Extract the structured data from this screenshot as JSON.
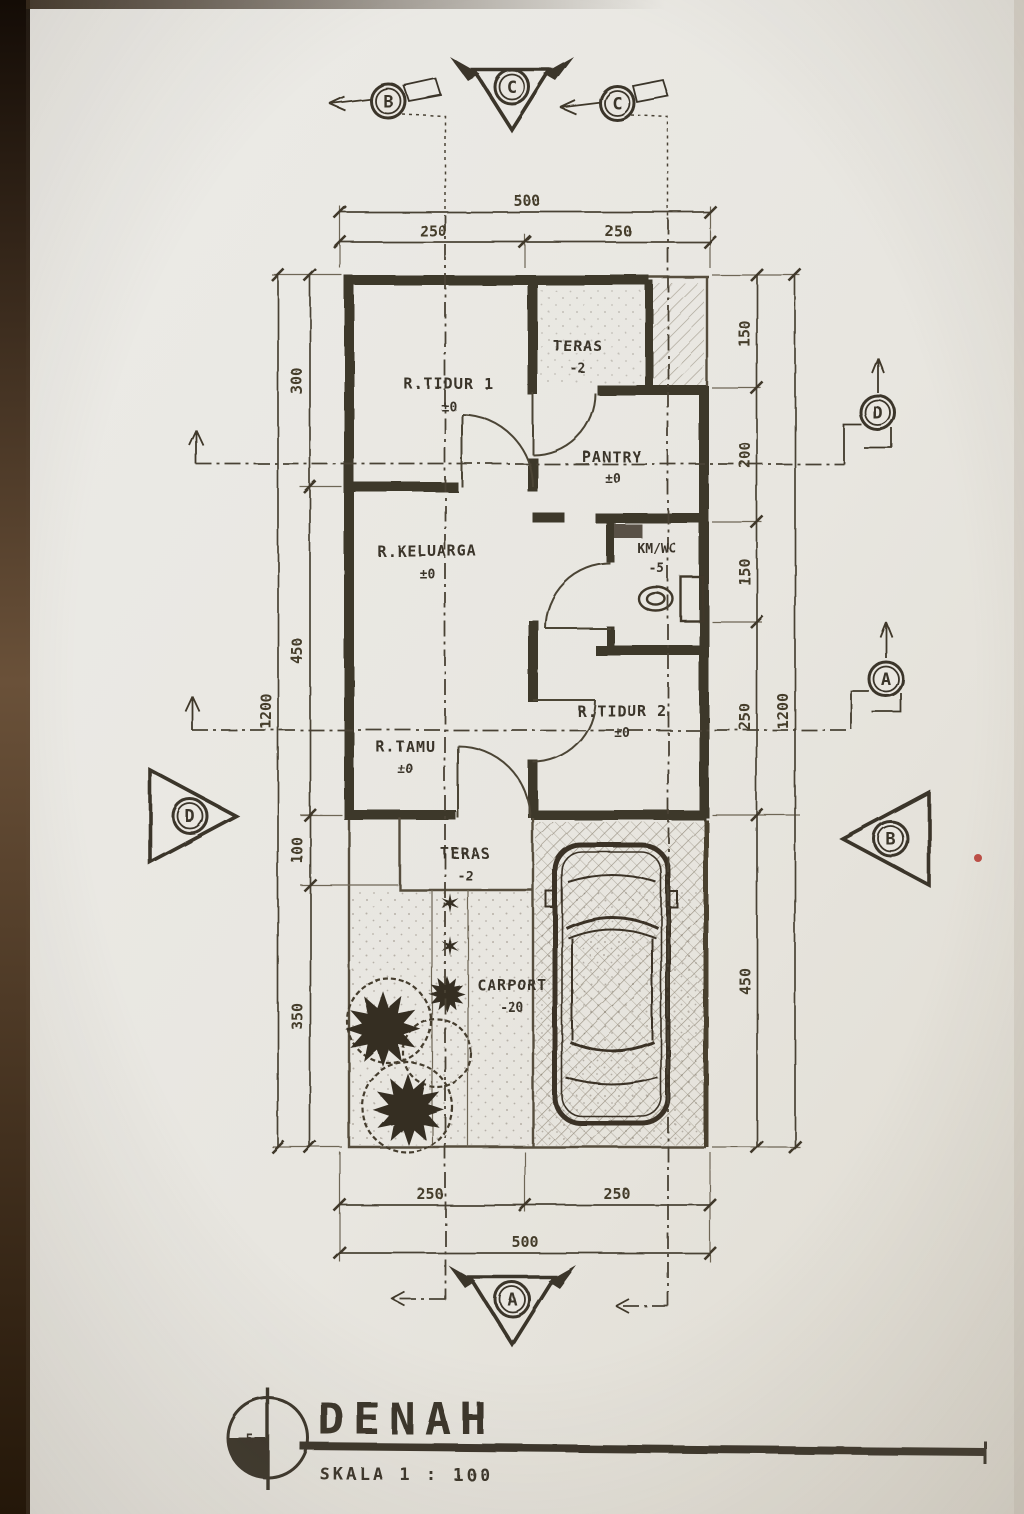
{
  "title_block": {
    "title": "DENAH",
    "scale": "SKALA 1 : 100",
    "sheet_number": "5"
  },
  "rooms": [
    {
      "name": "R.TIDUR 1",
      "elevation": "±0"
    },
    {
      "name": "TERAS",
      "elevation": "-2"
    },
    {
      "name": "PANTRY",
      "elevation": "±0"
    },
    {
      "name": "R.KELUARGA",
      "elevation": "±0"
    },
    {
      "name": "KM/WC",
      "elevation": "-5"
    },
    {
      "name": "R.TIDUR 2",
      "elevation": "±0"
    },
    {
      "name": "R.TAMU",
      "elevation": "±0"
    },
    {
      "name": "TERAS",
      "elevation": "-2"
    },
    {
      "name": "CARPORT",
      "elevation": "-20"
    }
  ],
  "dimensions": {
    "top": {
      "overall": "500",
      "segments": [
        "250",
        "250"
      ]
    },
    "bottom": {
      "overall": "500",
      "segments": [
        "250",
        "250"
      ]
    },
    "left": {
      "overall": "1200",
      "segments": [
        "300",
        "450",
        "100",
        "350"
      ]
    },
    "right": {
      "overall": "1200",
      "segments": [
        "150",
        "200",
        "150",
        "250",
        "450"
      ]
    }
  },
  "grid_markers": {
    "top": [
      "B",
      "C",
      "C"
    ],
    "right": [
      "D",
      "A",
      "B"
    ],
    "left": [
      "D"
    ],
    "bottom": [
      "A"
    ]
  },
  "icons": {
    "tree_star": "✹",
    "path_star": "✶"
  }
}
